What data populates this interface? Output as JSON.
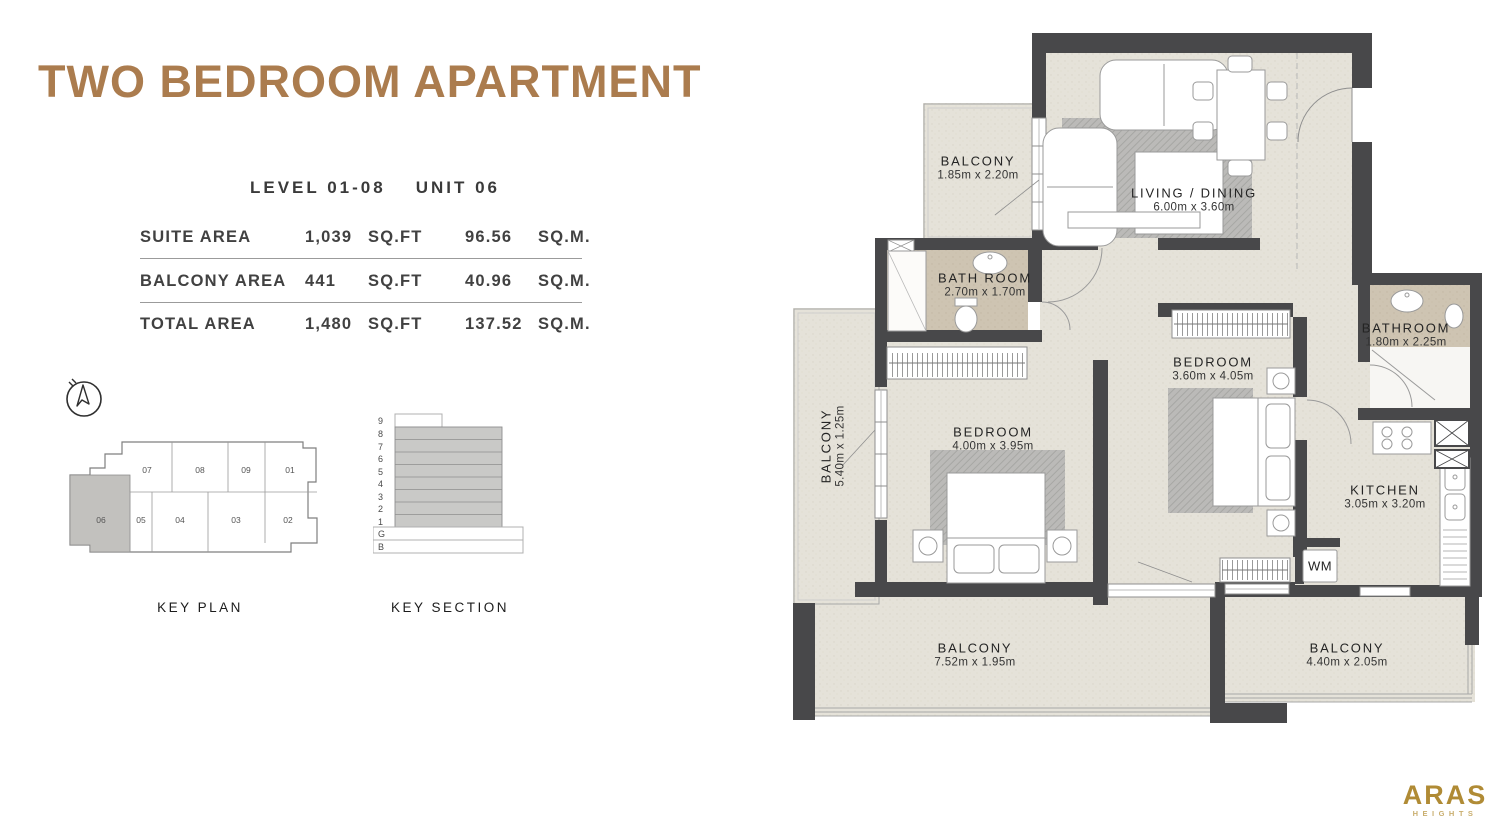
{
  "page": {
    "title": "TWO BEDROOM APARTMENT"
  },
  "unit_info": {
    "level": "LEVEL 01-08",
    "unit": "UNIT 06"
  },
  "area_table": {
    "rows": [
      {
        "label": "SUITE AREA",
        "sqft_value": "1,039",
        "sqft_unit": "SQ.FT",
        "sqm_value": "96.56",
        "sqm_unit": "SQ.M."
      },
      {
        "label": "BALCONY AREA",
        "sqft_value": "441",
        "sqft_unit": "SQ.FT",
        "sqm_value": "40.96",
        "sqm_unit": "SQ.M."
      },
      {
        "label": "TOTAL AREA",
        "sqft_value": "1,480",
        "sqft_unit": "SQ.FT",
        "sqm_value": "137.52",
        "sqm_unit": "SQ.M."
      }
    ]
  },
  "key_plan": {
    "caption": "KEY PLAN",
    "highlighted_unit": "06",
    "units": {
      "u07": "07",
      "u08": "08",
      "u09": "09",
      "u01": "01",
      "u06": "06",
      "u05": "05",
      "u04": "04",
      "u03": "03",
      "u02": "02"
    }
  },
  "key_section": {
    "caption": "KEY SECTION",
    "floors": [
      "9",
      "8",
      "7",
      "6",
      "5",
      "4",
      "3",
      "2",
      "1",
      "G",
      "B"
    ],
    "highlighted_floors": "1-8"
  },
  "floor_plan": {
    "rooms": [
      {
        "name": "BALCONY",
        "dims": "1.85m x 2.20m"
      },
      {
        "name": "LIVING / DINING",
        "dims": "6.00m x 3.60m"
      },
      {
        "name": "BATH ROOM",
        "dims": "2.70m x 1.70m"
      },
      {
        "name": "BALCONY",
        "dims": "5.40m x 1.25m"
      },
      {
        "name": "BEDROOM",
        "dims": "4.00m x 3.95m"
      },
      {
        "name": "BEDROOM",
        "dims": "3.60m x 4.05m"
      },
      {
        "name": "BATHROOM",
        "dims": "1.80m x 2.25m"
      },
      {
        "name": "KITCHEN",
        "dims": "3.05m x 3.20m"
      },
      {
        "name": "WM"
      },
      {
        "name": "BALCONY",
        "dims": "7.52m x 1.95m"
      },
      {
        "name": "BALCONY",
        "dims": "4.40m x 2.05m"
      }
    ]
  },
  "logo": {
    "brand": "ARAS",
    "subtitle": "HEIGHTS"
  },
  "colors": {
    "accent_brown": "#ab7c4e",
    "wall_dark": "#48484a",
    "floor_beige": "#e5e2d9",
    "bath_tan": "#cec4b2",
    "logo_gold": "#b08b35",
    "text_dark": "#3b3b3b",
    "keyplan_highlight": "#c2c1be"
  }
}
